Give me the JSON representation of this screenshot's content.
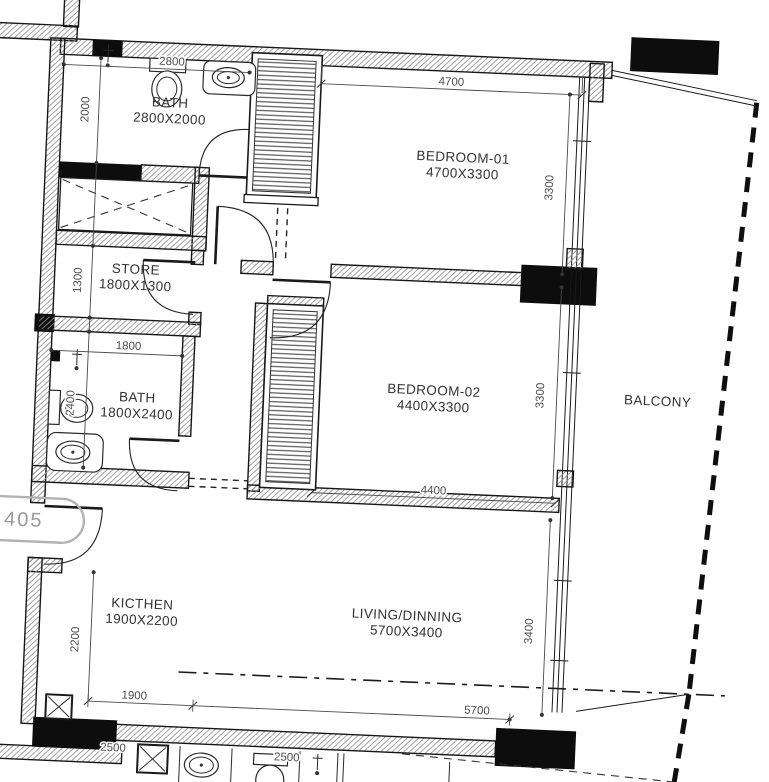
{
  "unit_badge": "405",
  "rooms": {
    "bath_top": {
      "name": "BATH",
      "size": "2800X2000"
    },
    "store": {
      "name": "STORE",
      "size": "1800X1300"
    },
    "bath_mid": {
      "name": "BATH",
      "size": "1800X2400"
    },
    "bedroom_01": {
      "name": "BEDROOM-01",
      "size": "4700X3300"
    },
    "bedroom_02": {
      "name": "BEDROOM-02",
      "size": "4400X3300"
    },
    "kitchen": {
      "name": "KICTHEN",
      "size": "1900X2200"
    },
    "living": {
      "name": "LIVING/DINNING",
      "size": "5700X3400"
    },
    "balcony": {
      "name": "BALCONY"
    }
  },
  "dims": {
    "bath_top_w": "2800",
    "bath_top_h": "2000",
    "bed1_w": "4700",
    "bed1_h": "3300",
    "store_h": "1300",
    "bath_mid_w": "1800",
    "bath_mid_h": "2400",
    "bed2_w": "4400",
    "bed2_h": "3300",
    "kitchen_h": "2200",
    "kitchen_w": "1900",
    "living_w": "5700",
    "living_h": "3400",
    "below_unit_a": "2500",
    "below_unit_b": "2500"
  },
  "colors": {
    "line": "#161616",
    "wall_fill_black": "#0d0d0d",
    "hatch": "#8f8f8f",
    "dim_text": "#4d4d4d",
    "label_text": "#333333",
    "bubble": "#9a9a9a"
  }
}
